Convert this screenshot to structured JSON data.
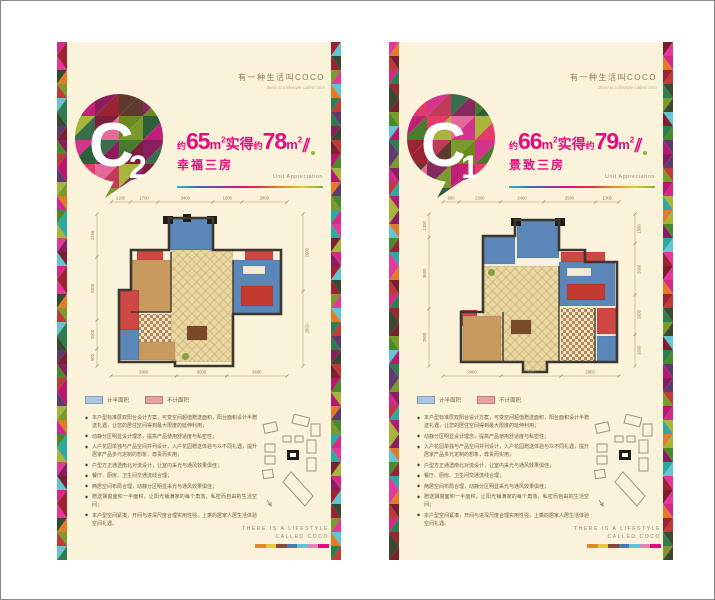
{
  "brand": {
    "title": "有一种生活叫COCO",
    "tagline": "there is a lifestyle called coco"
  },
  "footer": {
    "line1": "THERE IS A LIFESTYLE",
    "line2": "CALLED COCO"
  },
  "legend": {
    "half_label": "计半面积",
    "half_color": "#a9c6e2",
    "full_label": "不计面积",
    "full_color": "#e9a0a0"
  },
  "theme": {
    "panel_bg": "#faf3da",
    "magenta": "#e60b7f",
    "accent_dot": "#8fb53a",
    "dim_color": "#8a7a5a",
    "bullet_icon": "◆",
    "mosaic_palette": [
      "#b5186e",
      "#d12a8a",
      "#8a1d5e",
      "#e33a9a",
      "#2e7d4f",
      "#4a8a2e",
      "#7a9a2e",
      "#a8b43a",
      "#9c2333",
      "#c13a3a",
      "#7a1f2e",
      "#5e3a6e",
      "#2ea8a0",
      "#62c5d4",
      "#e07b2a",
      "#3a4a2e"
    ],
    "badge_palette": [
      "#4a7a2e",
      "#7a9a2e",
      "#2e5e3a",
      "#a8b43a",
      "#c02078",
      "#8a1d5e",
      "#d4328c",
      "#9c2333",
      "#7a1f3f",
      "#e33a6a",
      "#5e3a2e",
      "#3a6e4a",
      "#c13a5a",
      "#6a8a1e",
      "#e56a9a",
      "#842a5e"
    ],
    "rainbow_line": [
      "#2ab5c9",
      "#3a6eb5",
      "#8a3a9a",
      "#e5087e",
      "#d13a3a",
      "#e08a2a",
      "#d4c93a",
      "#7ab53a"
    ],
    "footer_bar": [
      "#e08a2a",
      "#e5c93a",
      "#8a4a3a",
      "#4a7ab5",
      "#5ec5d4",
      "#e582b0",
      "#e5087e"
    ],
    "rooms": {
      "blue": "#5b87b8",
      "red": "#cd4743",
      "redacc": "#c23a30",
      "tan_base": "#e9d7a2",
      "tan_line": "#c9a96e",
      "wood": "#c89a5e",
      "checker1": "#b5885a",
      "checker2": "#f0e2c2",
      "white": "#f2ead2",
      "table": "#7a4a28",
      "wall": "#3b372e",
      "pier": "#1f1c16",
      "plant": "#7a9a3a"
    }
  },
  "panels": [
    {
      "badge": {
        "letter": "C",
        "number": "2"
      },
      "headline": {
        "approx1": "约",
        "num1": "65",
        "unit": "m",
        "sup": "2",
        "mid": "实得",
        "approx2": "约",
        "num2": "78",
        "slash": "∥"
      },
      "subtitle": "幸福三房",
      "subtitle_en": "Unit Appreciation",
      "floorplan": {
        "dims": {
          "top": [
            "1200",
            "1700",
            "3400",
            "1800",
            "2800"
          ],
          "left": [
            "2250",
            "3300",
            "1500",
            "900"
          ],
          "right": [
            "2900",
            "2800"
          ],
          "bottom": [
            "3900",
            "3000",
            "3600"
          ]
        },
        "outline": "94,58 94,26 138,26 138,58 206,58 206,122 158,122 158,174 100,174 100,170 44,170 44,98 56,98 56,58",
        "walls": [
          [
            96,
            60,
            96,
            120
          ],
          [
            56,
            120,
            96,
            120
          ],
          [
            158,
            68,
            158,
            122
          ]
        ],
        "rooms": [
          [
            "blue",
            94,
            26,
            44,
            32
          ],
          [
            "red",
            62,
            58,
            26,
            10
          ],
          [
            "red",
            170,
            58,
            28,
            10
          ],
          [
            "wood",
            56,
            68,
            40,
            52
          ],
          [
            "tan",
            96,
            58,
            62,
            112
          ],
          [
            "blue",
            158,
            68,
            48,
            54
          ],
          [
            "white",
            168,
            74,
            22,
            8
          ],
          [
            "redacc",
            166,
            94,
            32,
            20
          ],
          [
            "red",
            44,
            98,
            20,
            40
          ],
          [
            "blue",
            44,
            138,
            20,
            30
          ],
          [
            "checker",
            64,
            122,
            32,
            28
          ],
          [
            "wood",
            64,
            150,
            36,
            18
          ],
          [
            "table",
            112,
            134,
            20,
            14
          ],
          [
            "plant",
            108,
            162,
            5,
            5
          ],
          [
            "pier",
            88,
            24,
            10,
            8
          ],
          [
            "pier",
            132,
            24,
            10,
            8
          ],
          [
            "pier",
            108,
            22,
            8,
            8
          ]
        ]
      },
      "bullets": [
        "本户型标准层双阳台设计方案，可变空间超值赠送面积，阳台面积设计半赠送礼遇，让您的居住空间得到最大限度的延伸利用；",
        "动静分区明显设计理念，提高产品使用舒适度与私密性；",
        "入户花园单独与产品空间并列设计，入户花园赠送体验与众不同礼遇，提升居家产品多元定制的想象，尊贵而实用；",
        "户型方正通透南北对流设计，让室内采光与通风效果俱佳；",
        "餐厅、厨房、卫生间交通流线合理；",
        "两居空间布局合理，动静分区明显采光与通风效果俱佳；",
        "赠送飘窗面积一半面积，让阳光铺满家的每个角落，私密而自由的生活空间；",
        "本户型空间紧凑，开间与进深尺度合理实用性强，上乘的居家人居生活体验空间礼遇。"
      ]
    },
    {
      "badge": {
        "letter": "C",
        "number": "1"
      },
      "headline": {
        "approx1": "约",
        "num1": "66",
        "unit": "m",
        "sup": "2",
        "mid": "实得",
        "approx2": "约",
        "num2": "79",
        "slash": "∥"
      },
      "subtitle": "景致三房",
      "subtitle_en": "Unit Appreciation",
      "floorplan": {
        "dims": {
          "top": [
            "900",
            "2300",
            "2400",
            "2900",
            "1300"
          ],
          "left": [
            "1200",
            "3600",
            "2900"
          ],
          "right": [
            "1500",
            "2600",
            "2000",
            "1600"
          ],
          "bottom": [
            "2900",
            "3000",
            "2900"
          ]
        },
        "outline": "76,44 108,44 108,28 152,28 152,58 178,58 178,70 210,70 210,170 140,170 140,180 116,180 116,170 54,170 54,120 76,120",
        "walls": [
          [
            152,
            74,
            152,
            170
          ],
          [
            96,
            120,
            96,
            170
          ],
          [
            188,
            116,
            188,
            170
          ]
        ],
        "rooms": [
          [
            "blue",
            76,
            44,
            32,
            28
          ],
          [
            "blue",
            110,
            28,
            42,
            38
          ],
          [
            "red",
            154,
            60,
            44,
            10
          ],
          [
            "blue",
            152,
            70,
            56,
            44
          ],
          [
            "white",
            160,
            76,
            24,
            8
          ],
          [
            "redacc",
            160,
            92,
            38,
            16
          ],
          [
            "tan",
            76,
            74,
            76,
            96
          ],
          [
            "red",
            54,
            118,
            16,
            16
          ],
          [
            "wood",
            56,
            124,
            38,
            46
          ],
          [
            "checker",
            154,
            116,
            34,
            54
          ],
          [
            "red",
            190,
            116,
            20,
            26
          ],
          [
            "blue",
            190,
            144,
            20,
            26
          ],
          [
            "table",
            104,
            128,
            20,
            14
          ],
          [
            "plant",
            82,
            78,
            5,
            5
          ],
          [
            "tan",
            116,
            170,
            24,
            9
          ],
          [
            "pier",
            104,
            26,
            10,
            8
          ],
          [
            "pier",
            148,
            26,
            10,
            8
          ]
        ]
      },
      "bullets": [
        "本户型标准层双阳台设计方案，可变空间超值赠送面积，阳台面积设计半赠送礼遇，让您的居住空间得到最大限度的延伸利用；",
        "动静分区明显设计理念，提高产品使用舒适度与私密性；",
        "入户花园单独与产品空间并列设计，入户花园赠送体验与众不同礼遇，提升居家产品多元定制的想象，尊贵而实用；",
        "户型方正通透南北对流设计，让室内采光与通风效果俱佳；",
        "餐厅、厨房、卫生间交通流线合理；",
        "两居空间布局合理，动静分区明显采光与通风效果俱佳；",
        "赠送飘窗面积一半面积，让阳光铺满家的每个角落，私密而自由的生活空间；",
        "本户型空间紧凑，开间与进深尺度合理实用性强，上乘的居家人居生活体验空间礼遇。"
      ]
    }
  ]
}
